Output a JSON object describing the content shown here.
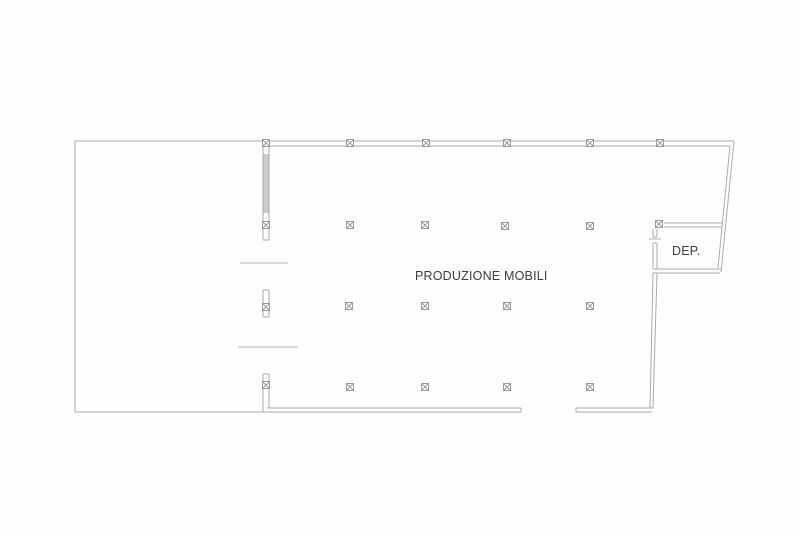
{
  "meta": {
    "drawing_type": "architectural floor plan",
    "background_color": "#fefefe",
    "wall_line_color": "#ababab",
    "dash_line_color": "#b3b3b3",
    "marker_line_color": "#9b9b9b",
    "wall_fill_color": "#cbcbcb",
    "text_color": "#3d3d3d"
  },
  "labels": {
    "main_room": "PRODUZIONE MOBILI",
    "storage_room": "DEP."
  },
  "plan": {
    "walls": [
      {
        "x1": 75,
        "y1": 141,
        "x2": 75,
        "y2": 412
      },
      {
        "x1": 75,
        "y1": 412,
        "x2": 521,
        "y2": 412
      },
      {
        "x1": 267,
        "y1": 408,
        "x2": 521,
        "y2": 408
      },
      {
        "x1": 521,
        "y1": 408,
        "x2": 521,
        "y2": 412
      },
      {
        "x1": 576,
        "y1": 408,
        "x2": 653,
        "y2": 408
      },
      {
        "x1": 576,
        "y1": 412,
        "x2": 652,
        "y2": 412
      },
      {
        "x1": 576,
        "y1": 408,
        "x2": 576,
        "y2": 412
      },
      {
        "x1": 75,
        "y1": 141,
        "x2": 266,
        "y2": 141
      },
      {
        "x1": 266,
        "y1": 141,
        "x2": 734,
        "y2": 141
      },
      {
        "x1": 266,
        "y1": 146,
        "x2": 730,
        "y2": 146
      },
      {
        "x1": 734,
        "y1": 141,
        "x2": 721,
        "y2": 272
      },
      {
        "x1": 730,
        "y1": 146,
        "x2": 718,
        "y2": 268
      },
      {
        "x1": 664,
        "y1": 223,
        "x2": 723,
        "y2": 223
      },
      {
        "x1": 664,
        "y1": 227,
        "x2": 722,
        "y2": 227
      },
      {
        "x1": 653,
        "y1": 229,
        "x2": 653,
        "y2": 237
      },
      {
        "x1": 657,
        "y1": 229,
        "x2": 657,
        "y2": 237
      },
      {
        "x1": 653,
        "y1": 237,
        "x2": 657,
        "y2": 237
      },
      {
        "x1": 653,
        "y1": 243,
        "x2": 653,
        "y2": 269
      },
      {
        "x1": 657,
        "y1": 243,
        "x2": 657,
        "y2": 269
      },
      {
        "x1": 653,
        "y1": 243,
        "x2": 657,
        "y2": 243
      },
      {
        "x1": 653,
        "y1": 269,
        "x2": 722,
        "y2": 269
      },
      {
        "x1": 653,
        "y1": 273,
        "x2": 720,
        "y2": 273
      },
      {
        "x1": 653,
        "y1": 273,
        "x2": 650,
        "y2": 408
      },
      {
        "x1": 657,
        "y1": 273,
        "x2": 653,
        "y2": 408
      },
      {
        "x1": 263,
        "y1": 146,
        "x2": 263,
        "y2": 240
      },
      {
        "x1": 269,
        "y1": 146,
        "x2": 269,
        "y2": 240
      },
      {
        "x1": 263,
        "y1": 240,
        "x2": 269,
        "y2": 240
      },
      {
        "x1": 263,
        "y1": 290,
        "x2": 263,
        "y2": 317
      },
      {
        "x1": 269,
        "y1": 290,
        "x2": 269,
        "y2": 317
      },
      {
        "x1": 263,
        "y1": 290,
        "x2": 269,
        "y2": 290
      },
      {
        "x1": 263,
        "y1": 317,
        "x2": 269,
        "y2": 317
      },
      {
        "x1": 263,
        "y1": 374,
        "x2": 263,
        "y2": 412
      },
      {
        "x1": 269,
        "y1": 374,
        "x2": 269,
        "y2": 408
      },
      {
        "x1": 263,
        "y1": 374,
        "x2": 269,
        "y2": 374
      }
    ],
    "filled_walls": [
      {
        "x": 263.5,
        "y": 154,
        "w": 5,
        "h": 59
      }
    ],
    "door_dashes": [
      {
        "x1": 240,
        "y1": 263,
        "x2": 288,
        "y2": 263
      },
      {
        "x1": 238,
        "y1": 347,
        "x2": 298,
        "y2": 347
      },
      {
        "x1": 649,
        "y1": 239,
        "x2": 661,
        "y2": 239
      }
    ],
    "columns": {
      "size": 7,
      "points": [
        {
          "x": 266,
          "y": 143
        },
        {
          "x": 350,
          "y": 143
        },
        {
          "x": 426,
          "y": 143
        },
        {
          "x": 507,
          "y": 143
        },
        {
          "x": 590,
          "y": 143
        },
        {
          "x": 660,
          "y": 143
        },
        {
          "x": 266,
          "y": 225
        },
        {
          "x": 350,
          "y": 225
        },
        {
          "x": 425,
          "y": 225
        },
        {
          "x": 505,
          "y": 226
        },
        {
          "x": 590,
          "y": 226
        },
        {
          "x": 659,
          "y": 224
        },
        {
          "x": 266,
          "y": 307
        },
        {
          "x": 349,
          "y": 306
        },
        {
          "x": 425,
          "y": 306
        },
        {
          "x": 507,
          "y": 306
        },
        {
          "x": 590,
          "y": 306
        },
        {
          "x": 266,
          "y": 385
        },
        {
          "x": 350,
          "y": 387
        },
        {
          "x": 425,
          "y": 387
        },
        {
          "x": 507,
          "y": 387
        },
        {
          "x": 590,
          "y": 387
        }
      ]
    }
  }
}
